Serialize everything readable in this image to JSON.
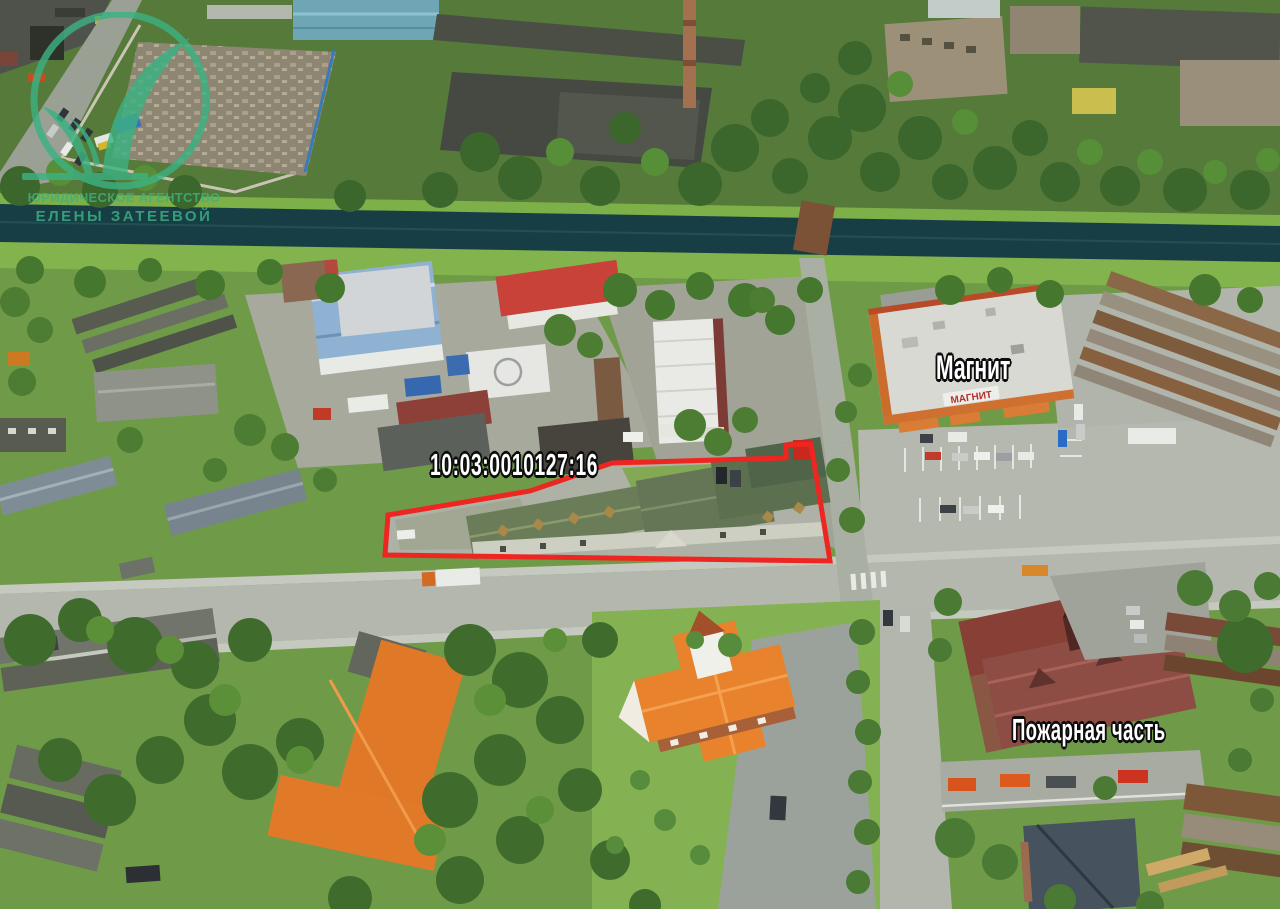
{
  "annotations": {
    "cadastral_number": "10:03:0010127:16",
    "store_label": "Магнит",
    "fire_station_label": "Пожарная часть"
  },
  "watermark": {
    "line1": "ЮРИДИЧЕСКОЕ АГЕНТСТВО",
    "line2": "ЕЛЕНЫ ЗАТЕЕВОЙ"
  },
  "scene": {
    "magnit_roof_sign": "МАГНИТ",
    "colors": {
      "boundary_red": "#ee2621",
      "logo_green": "#3cb282",
      "annotation_text": "#ffffff",
      "annotation_outline": "#0d0d0d"
    }
  }
}
